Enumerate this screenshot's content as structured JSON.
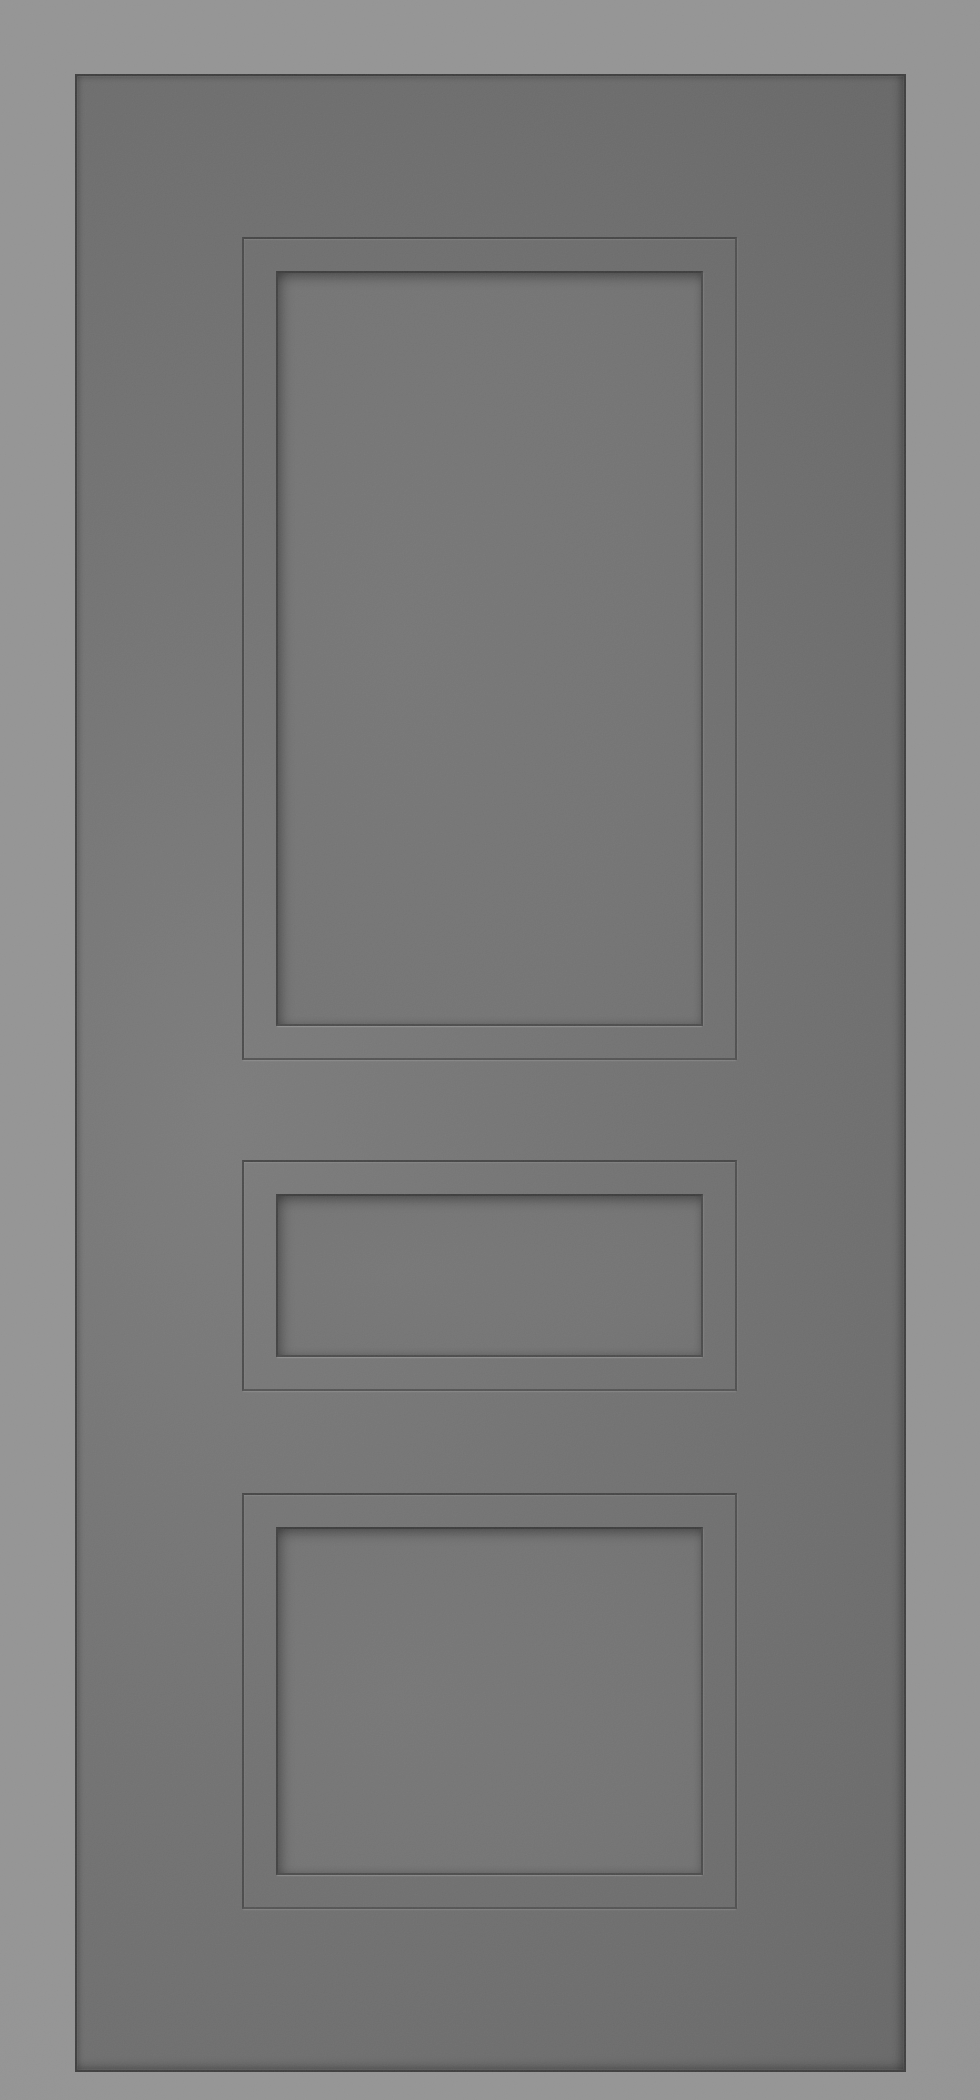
{
  "scene": {
    "description": "Front-view render of a grey three-panel interior door slab on a plain light-grey backdrop",
    "object": "three-panel interior door",
    "panel_count": 3,
    "panels": [
      {
        "id": "top-panel",
        "shape": "tall vertical rectangle"
      },
      {
        "id": "middle-panel",
        "shape": "short wide rectangle"
      },
      {
        "id": "bottom-panel",
        "shape": "medium rectangle"
      }
    ],
    "hardware": "none visible",
    "text": ""
  },
  "colors": {
    "background": "#929292",
    "background_edge": "#8d8d8d",
    "door_face": "#6e6e6e",
    "door_face_light": "#787878",
    "door_face_dark": "#626262",
    "door_outline": "#383838",
    "groove_dark": "#454545",
    "panel_edge_dark": "#373737",
    "bevel_highlight": "#828282",
    "panel_face": "#707070",
    "panel_face_dark": "#696969"
  }
}
